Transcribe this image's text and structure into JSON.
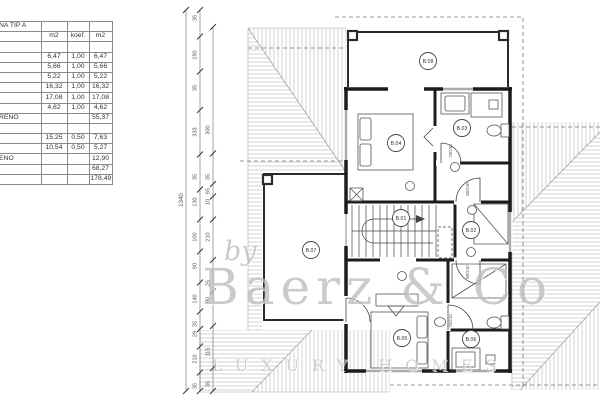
{
  "table": {
    "title_fragment": "NA TIP A",
    "col_headers": [
      "m2",
      "koef.",
      "m2"
    ],
    "rows": [
      [
        "NA TIP A",
        "",
        "",
        ""
      ],
      [
        "",
        "m2",
        "koef.",
        "m2"
      ],
      [
        "",
        "",
        "",
        ""
      ],
      [
        "",
        "6,47",
        "1,00",
        "6,47"
      ],
      [
        "",
        "5,66",
        "1,00",
        "5,66"
      ],
      [
        "",
        "5,22",
        "1,00",
        "5,22"
      ],
      [
        "",
        "16,32",
        "1,00",
        "16,32"
      ],
      [
        "",
        "17,08",
        "1,00",
        "17,08"
      ],
      [
        "",
        "4,62",
        "1,00",
        "4,62"
      ],
      [
        "RENO",
        "",
        "",
        "55,37"
      ],
      [
        "",
        "",
        "",
        ""
      ],
      [
        "",
        "15,25",
        "0,50",
        "7,63"
      ],
      [
        "",
        "10,54",
        "0,50",
        "5,27"
      ],
      [
        "ENO",
        "",
        "",
        "12,90"
      ],
      [
        "",
        "",
        "",
        "68,27"
      ],
      [
        "",
        "",
        "",
        "178,49"
      ]
    ]
  },
  "plan": {
    "room_labels": [
      {
        "id": "B.01",
        "x": 401,
        "y": 218
      },
      {
        "id": "B.02",
        "x": 471,
        "y": 230
      },
      {
        "id": "B.03",
        "x": 462,
        "y": 128
      },
      {
        "id": "B.04",
        "x": 396,
        "y": 143
      },
      {
        "id": "B.05",
        "x": 402,
        "y": 338
      },
      {
        "id": "B.06",
        "x": 471,
        "y": 339
      },
      {
        "id": "B.07",
        "x": 311,
        "y": 250
      },
      {
        "id": "B.08",
        "x": 428,
        "y": 61
      }
    ],
    "door_labels": [
      {
        "text": "70/210",
        "x": 452,
        "y": 151
      },
      {
        "text": "80/210",
        "x": 469,
        "y": 189
      },
      {
        "text": "80/210",
        "x": 469,
        "y": 272
      },
      {
        "text": "70/210",
        "x": 452,
        "y": 321
      }
    ],
    "dimensions": {
      "overall": {
        "text": "1340",
        "x": 184,
        "y": 200
      },
      "chain_a": {
        "x": 200,
        "labels": [
          {
            "text": "35",
            "y": 18
          },
          {
            "text": "190",
            "y": 55
          },
          {
            "text": "35",
            "y": 88
          },
          {
            "text": "333",
            "y": 132
          },
          {
            "text": "35",
            "y": 177
          },
          {
            "text": "130",
            "y": 202
          },
          {
            "text": "100",
            "y": 237
          },
          {
            "text": "90",
            "y": 266
          },
          {
            "text": "140",
            "y": 299
          },
          {
            "text": "35",
            "y": 324
          },
          {
            "text": "29",
            "y": 334
          },
          {
            "text": "210",
            "y": 359
          },
          {
            "text": "35",
            "y": 386
          }
        ]
      },
      "chain_b": {
        "x": 213,
        "labels": [
          {
            "text": "300",
            "y": 130
          },
          {
            "text": "35",
            "y": 177
          },
          {
            "text": "65",
            "y": 191
          },
          {
            "text": "10",
            "y": 202
          },
          {
            "text": "210",
            "y": 237
          },
          {
            "text": "25",
            "y": 283
          },
          {
            "text": "90",
            "y": 300
          },
          {
            "text": "115",
            "y": 352
          },
          {
            "text": "35",
            "y": 384
          }
        ]
      }
    }
  },
  "watermark": {
    "by": "by",
    "brand": "Baerz & Co",
    "tagline": "LUXURY HOMES"
  },
  "colors": {
    "line": "#2a2a2a",
    "hatch": "#b5b5b5",
    "dim": "#555555",
    "watermark": "#c0c0c0"
  }
}
